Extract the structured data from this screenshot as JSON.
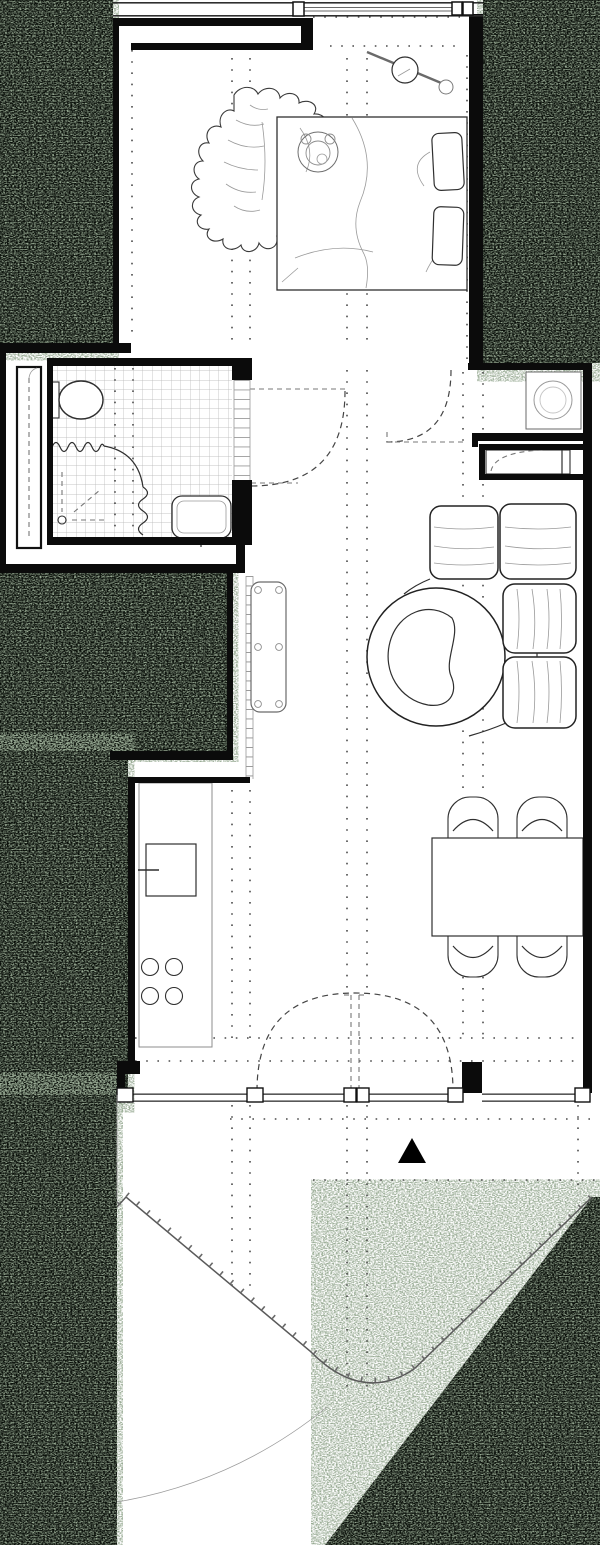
{
  "meta": {
    "title": "Studio apartment floor plan with curved balcony",
    "type": "architectural-floor-plan",
    "canvas": {
      "width": 600,
      "height": 1545
    }
  },
  "colors": {
    "wall": "#0b0b0b",
    "floor": "#ffffff",
    "outside_base": "#070c07",
    "outside_speckle": "#52694e",
    "drawing_line": "#2f2f2f",
    "light_line": "#9a9a9a",
    "guide_dots": "#4a4a4a"
  },
  "rooms": {
    "bedroom": "bedroom",
    "bathroom": "bathroom",
    "hallway": "hallway",
    "entry": "entry hall",
    "living": "living / dining room",
    "kitchen": "kitchen",
    "balcony": "curved balcony"
  },
  "furniture": {
    "bed": "double bed",
    "pillows": "two pillows",
    "teddy_bear": "teddy bear on bed",
    "rug": "animal-hide rug",
    "lamp": "pendant lamp with rod",
    "toilet": "toilet with cistern",
    "shower": "shower with wavy curtain",
    "drain": "shower floor drain",
    "washbasin": "washbasin",
    "tiles": "tiled bathroom floor",
    "wardrobe": "tall wardrobe with sliding door",
    "washing_machine": "washing machine in niche",
    "closet": "built-in entry closet",
    "desk": "wall-mounted desk with grommets",
    "sofa": "modular corner sofa",
    "lounge_chair": "round lounge chair with cut-out",
    "dining_table": "rectangular dining table",
    "dining_chairs": "four dining chairs",
    "counter": "kitchen counter run",
    "sink": "kitchen sink with tap",
    "cooktop": "four-burner cooktop",
    "railing": "curved balcony railing",
    "balcony_door": "double balcony door swing",
    "entry_door": "entry door swing",
    "bathroom_door": "bathroom pocket door",
    "north_marker": "solid triangle marker"
  },
  "counts": {
    "pillows": 2,
    "sofa_back_cushions": 4,
    "dining_chairs": 4,
    "cooktop_burners": 4,
    "glazing_mullions": 6
  }
}
